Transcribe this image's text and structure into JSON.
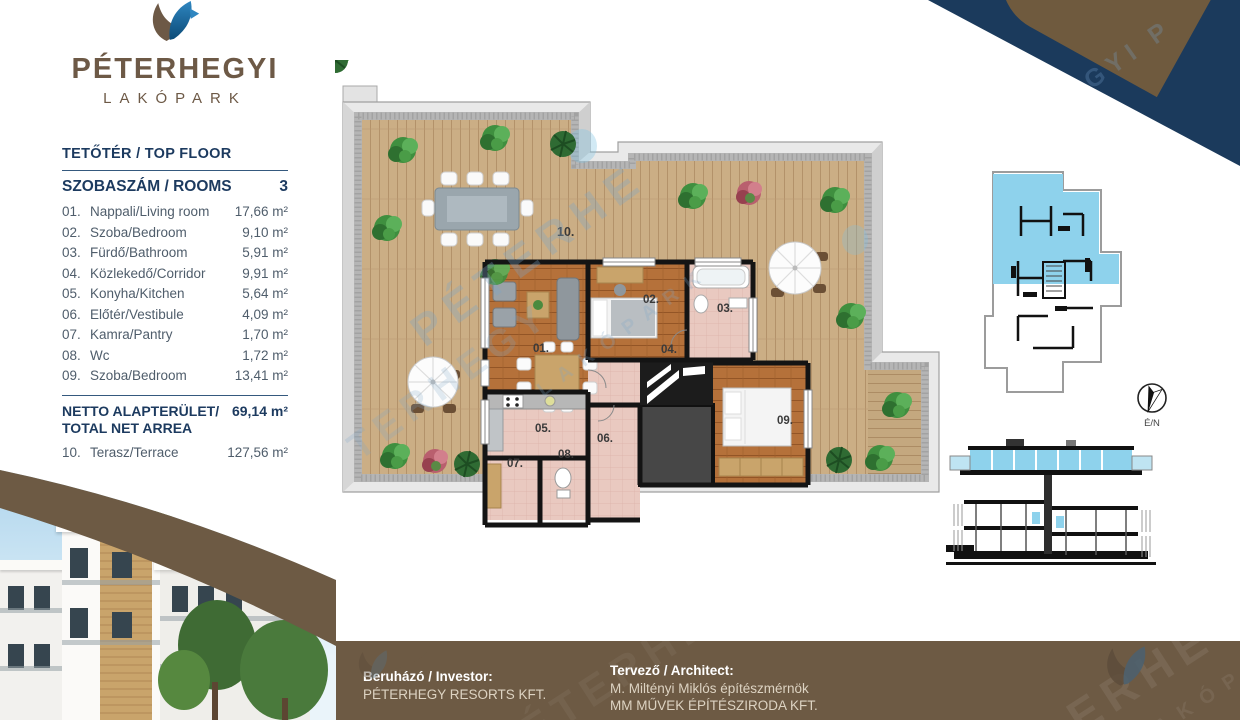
{
  "logo": {
    "title": "PÉTERHEGYI",
    "subtitle": "LAKÓPARK"
  },
  "panel": {
    "floor_title": "TETŐTÉR / TOP FLOOR",
    "rooms_label": "SZOBASZÁM / ROOMS",
    "rooms_value": "3",
    "rooms": [
      {
        "num": "01.",
        "name": "Nappali/Living room",
        "area": "17,66 m²"
      },
      {
        "num": "02.",
        "name": "Szoba/Bedroom",
        "area": "9,10 m²"
      },
      {
        "num": "03.",
        "name": "Fürdő/Bathroom",
        "area": "5,91 m²"
      },
      {
        "num": "04.",
        "name": "Közlekedő/Corridor",
        "area": "9,91 m²"
      },
      {
        "num": "05.",
        "name": "Konyha/Kitchen",
        "area": "5,64 m²"
      },
      {
        "num": "06.",
        "name": "Előtér/Vestibule",
        "area": "4,09 m²"
      },
      {
        "num": "07.",
        "name": "Kamra/Pantry",
        "area": "1,70 m²"
      },
      {
        "num": "08.",
        "name": "Wc",
        "area": "1,72 m²"
      },
      {
        "num": "09.",
        "name": "Szoba/Bedroom",
        "area": "13,41 m²"
      }
    ],
    "net_label_line1": "NETTO ALAPTERÜLET/",
    "net_label_line2": "TOTAL NET ARREA",
    "net_value": "69,14 m²",
    "terrace_row": {
      "num": "10.",
      "name": "Terasz/Terrace",
      "area": "127,56 m²"
    }
  },
  "plan": {
    "labels": {
      "r01": "01.",
      "r02": "02.",
      "r03": "03.",
      "r04": "04.",
      "r05": "05.",
      "r06": "06.",
      "r07": "07.",
      "r08": "08.",
      "r09": "09.",
      "r10": "10."
    }
  },
  "compass": {
    "label": "É/N"
  },
  "footer": {
    "investor_label": "Beruházó / Investor:",
    "investor_name": "PÉTERHEGY RESORTS KFT.",
    "architect_label": "Tervező / Architect:",
    "architect_line1": "M. Miltényi Miklós építészmérnök",
    "architect_line2": "MM MŰVEK ÉPÍTÉSZIRODA KFT."
  },
  "watermarks": {
    "w1": "PÉTERHE",
    "w2": "TERHEGY",
    "w3": "LAKÓPARK",
    "w4": "GYI  P",
    "w5": "ÉTERHEGYI",
    "w6": "ERHEGYI"
  },
  "colors": {
    "navy": "#1b3a5c",
    "brown": "#6d5a44",
    "accent_blue": "#8ed2ec"
  }
}
